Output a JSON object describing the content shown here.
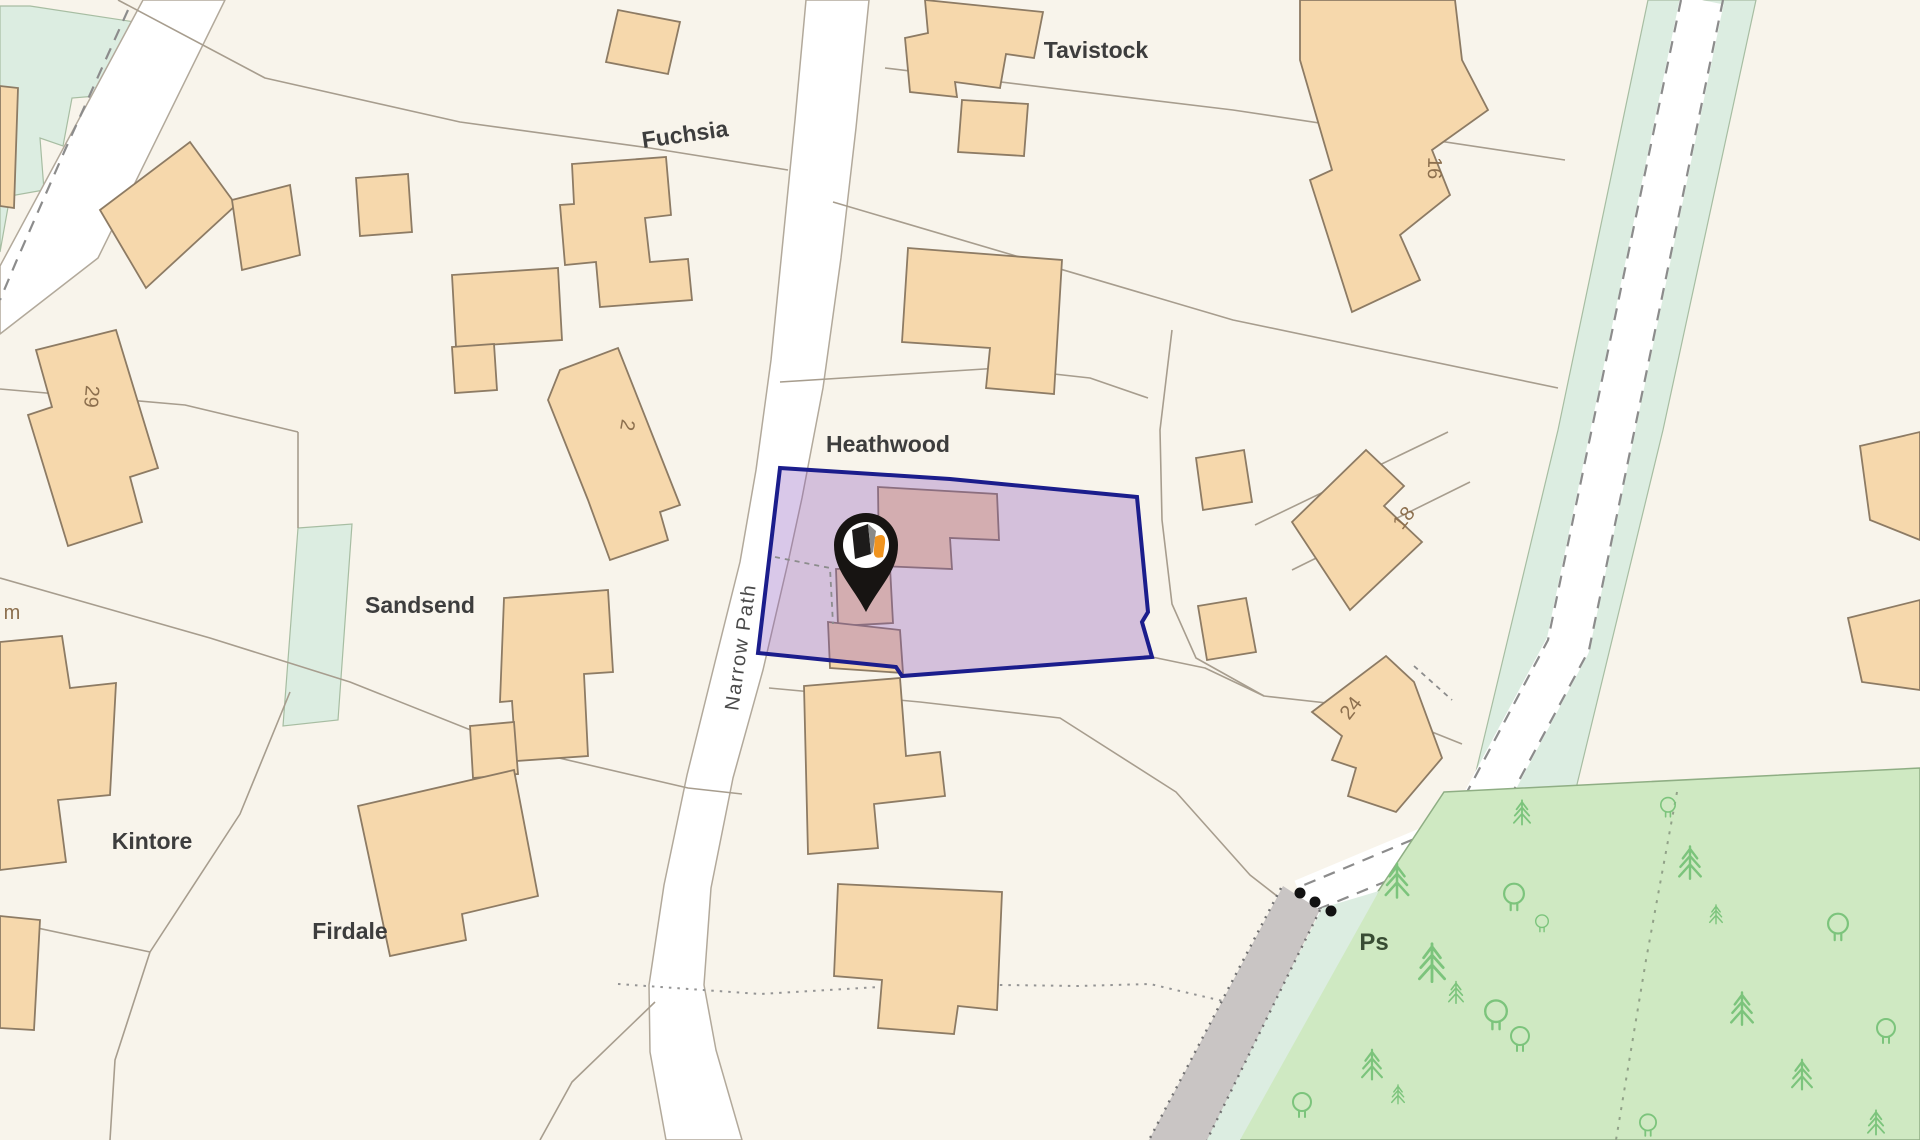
{
  "map": {
    "title": "Property location map",
    "labels": {
      "tavistock": "Tavistock",
      "fuchsia": "Fuchsia",
      "heathwood": "Heathwood",
      "sandsend": "Sandsend",
      "kintore": "Kintore",
      "firdale": "Firdale",
      "narrow_path": "Narrow Path",
      "ps": "Ps",
      "m_partial": "m",
      "n29": "29",
      "n2": "2",
      "n16": "16",
      "n18": "18",
      "n24": "24"
    },
    "marker": {
      "name": "property-location-pin",
      "shape": "teardrop pin with white disc and dark/orange brand glyph"
    },
    "colors": {
      "background": "#f8f4eb",
      "building_fill": "#f6d8ac",
      "building_stroke": "#8d7b64",
      "boundary_line": "#a79d8e",
      "road_fill": "#ffffff",
      "road_casing": "#b2a99b",
      "green_area": "#dcede1",
      "green_stroke": "#a7bda2",
      "woodland_fill": "#cfe9c2",
      "woodland_stroke": "#8fae84",
      "tree": "#7cc47c",
      "track_gray": "#c9c5c4",
      "track_dot": "#707070",
      "dash_gray": "#8c8c8c",
      "parcel_fill": "rgba(136,84,188,0.32)",
      "parcel_stroke": "#1b1d8c",
      "label_dark": "#3d3d3d",
      "number_brown": "#8c6f4e",
      "ps_green": "#384c33",
      "pin_black": "#171412",
      "pin_ring": "#ffffff",
      "glyph_dark": "#1d1b1a",
      "glyph_gray": "#8a8a88",
      "glyph_accent": "#f0941f"
    }
  }
}
